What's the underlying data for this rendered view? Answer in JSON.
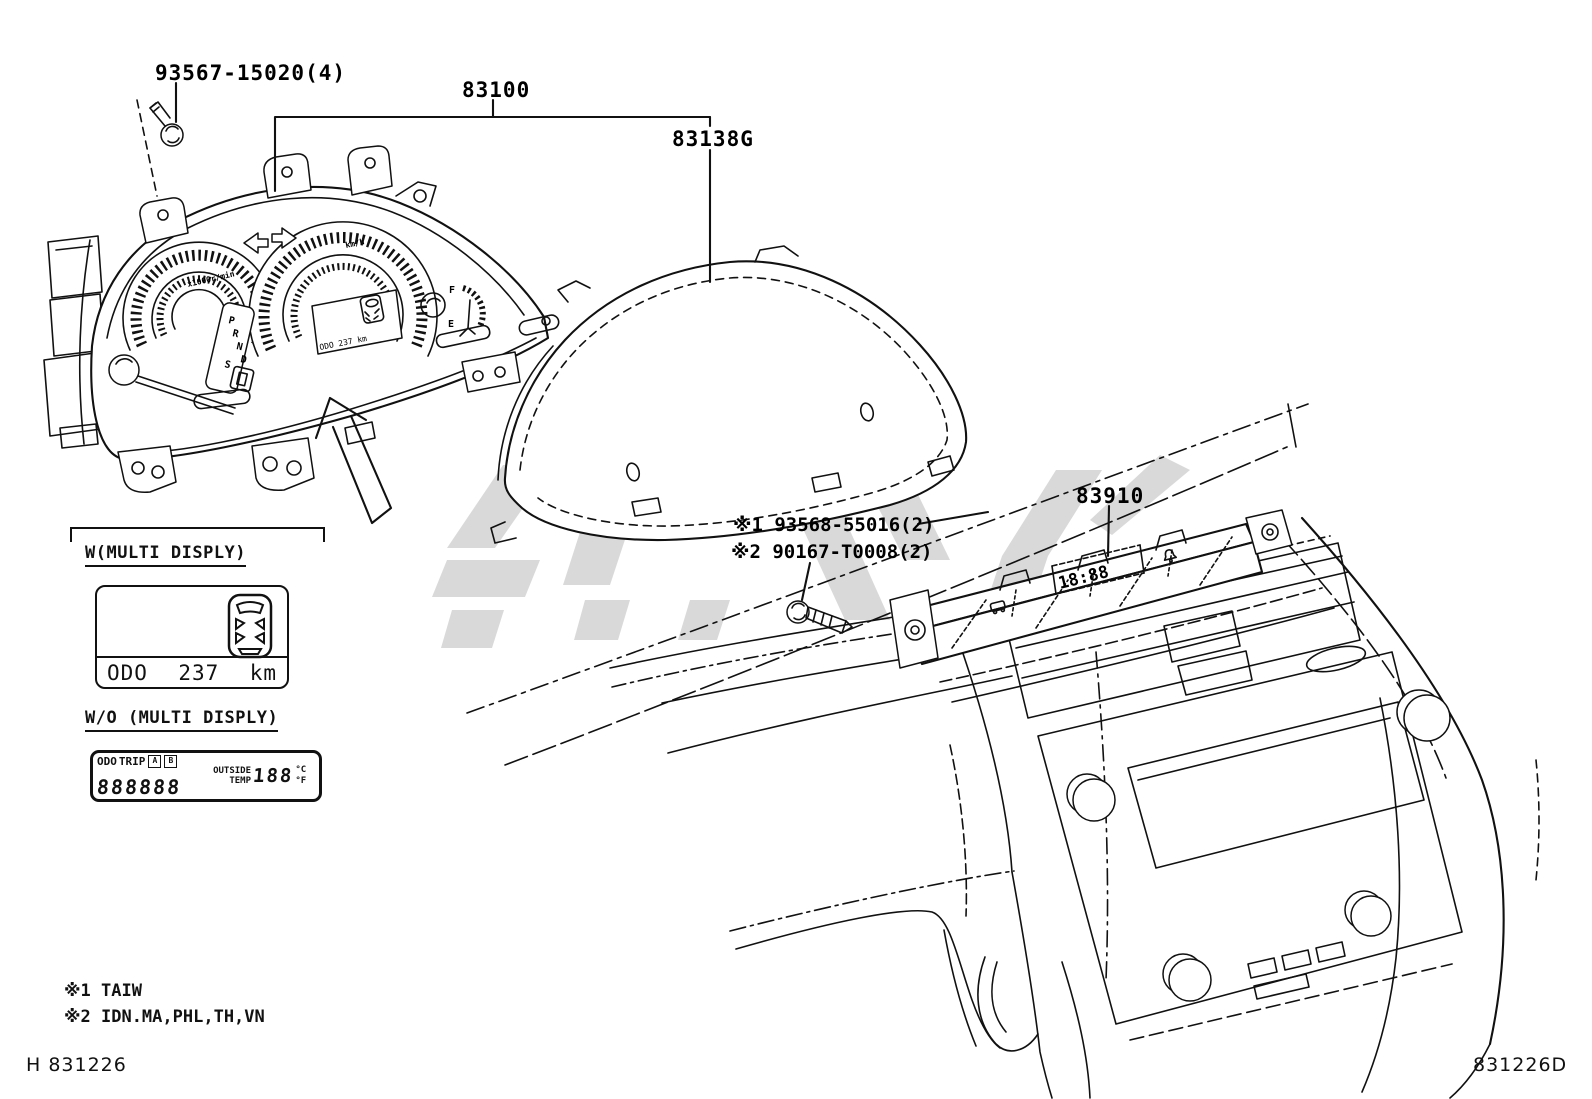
{
  "doc": {
    "left_code": "H 831226",
    "right_code": "831226D"
  },
  "parts": {
    "screw_top": "93567-15020(4)",
    "cluster": "83100",
    "lens": "83138G",
    "center_display": "83910",
    "note1": "※1 93568-55016(2)",
    "note2": "※2 90167-T0008(2)"
  },
  "footnotes": {
    "line1": "※1 TAIW",
    "line2": "※2 IDN.MA,PHL,TH,VN"
  },
  "cluster_face": {
    "tach_label": "x1000r/min",
    "speed_label": "km/h",
    "gear": [
      "P",
      "R",
      "N",
      "D",
      "S"
    ],
    "odo_text": "ODO 237 km",
    "fuel_full": "F",
    "fuel_empty": "E"
  },
  "center_unit": {
    "clock": "18:88"
  },
  "multi_display": {
    "with_title": "W(MULTI DISPLY)",
    "odo_label": "ODO",
    "odo_value": "237",
    "odo_unit": "km",
    "without_title": "W/O (MULTI DISPLY)",
    "lcd": {
      "odo": "ODO",
      "trip": "TRIP",
      "a": "A",
      "b": "B",
      "digits": "888888",
      "outside": "OUTSIDE",
      "temp": "TEMP",
      "temp_value": "188",
      "deg_c": "°C",
      "deg_f": "°F"
    }
  },
  "colors": {
    "ink": "#111111",
    "watermark": "#b3b3b3",
    "paper": "#ffffff"
  }
}
